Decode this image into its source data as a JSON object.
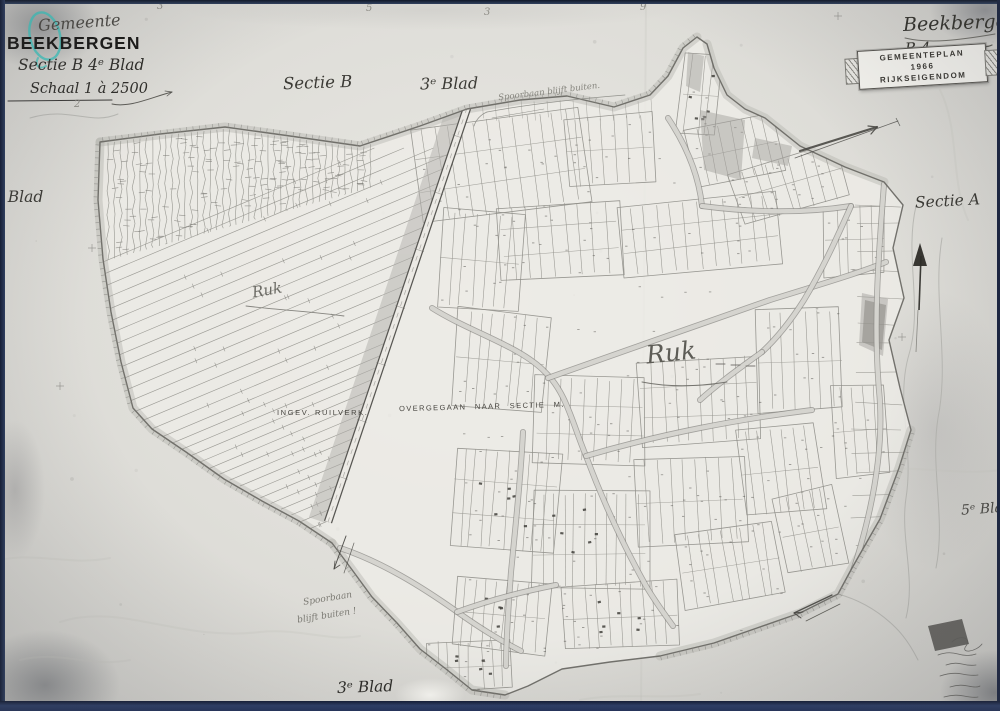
{
  "title_block": {
    "gemeente": "Gemeente",
    "municipality": "BEEKBERGEN",
    "sectie": "Sectie B 4ᵉ Blad",
    "schaal": "Schaal 1 à 2500"
  },
  "top_right": {
    "script_name": "Beekbergen",
    "script_sheet": "B 4.",
    "stamp_line1": "GEMEENTEPLAN 1966",
    "stamp_line2": "RIJKSEIGENDOM"
  },
  "sheet_labels": {
    "sectie_b": "Sectie B",
    "blad_top": "3ᵉ Blad",
    "sectie_a": "Sectie A",
    "blad_left": "5ᵉ Blad",
    "blad_bottom": "3ᵉ Blad",
    "blad_right": "5ᵉ Blad"
  },
  "annotations": {
    "spoorbaan_top": "Spoorbaan blijft buiten.",
    "spoorbaan_bottom_line1": "Spoorbaan",
    "spoorbaan_bottom_line2": "blijft buiten !",
    "ruk_small": "Ruk",
    "ruk_large": "Ruk",
    "ingev_ruilverk": "INGEV. RUILVERK.",
    "overgegaan": "OVERGEGAAN NAAR SECTIE M."
  },
  "edge_numbers": [
    "3",
    "5",
    "3",
    "9",
    "2"
  ],
  "colors": {
    "paper": "#deddd8",
    "paper_light": "#edece7",
    "ink": "#2b2a26",
    "line": "#94938d",
    "boundary": "#6b6a65",
    "band": "#b6b5b0",
    "teal": "#3fc6bf",
    "navy": "#22304f"
  },
  "map_art": {
    "boundary_points": [
      [
        100,
        142
      ],
      [
        160,
        134
      ],
      [
        225,
        127
      ],
      [
        290,
        136
      ],
      [
        360,
        146
      ],
      [
        420,
        126
      ],
      [
        467,
        109
      ],
      [
        520,
        100
      ],
      [
        567,
        96
      ],
      [
        614,
        107
      ],
      [
        650,
        95
      ],
      [
        668,
        76
      ],
      [
        683,
        48
      ],
      [
        697,
        37
      ],
      [
        707,
        44
      ],
      [
        714,
        68
      ],
      [
        727,
        95
      ],
      [
        745,
        109
      ],
      [
        765,
        118
      ],
      [
        800,
        146
      ],
      [
        845,
        167
      ],
      [
        884,
        182
      ],
      [
        903,
        205
      ],
      [
        893,
        248
      ],
      [
        904,
        298
      ],
      [
        889,
        340
      ],
      [
        900,
        388
      ],
      [
        911,
        430
      ],
      [
        899,
        468
      ],
      [
        880,
        519
      ],
      [
        852,
        568
      ],
      [
        838,
        594
      ],
      [
        800,
        613
      ],
      [
        757,
        628
      ],
      [
        714,
        643
      ],
      [
        660,
        656
      ],
      [
        610,
        662
      ],
      [
        562,
        669
      ],
      [
        528,
        686
      ],
      [
        505,
        695
      ],
      [
        472,
        690
      ],
      [
        446,
        669
      ],
      [
        420,
        649
      ],
      [
        397,
        623
      ],
      [
        372,
        597
      ],
      [
        350,
        567
      ],
      [
        332,
        543
      ],
      [
        299,
        521
      ],
      [
        262,
        501
      ],
      [
        224,
        479
      ],
      [
        186,
        452
      ],
      [
        152,
        429
      ],
      [
        133,
        408
      ],
      [
        121,
        362
      ],
      [
        111,
        312
      ],
      [
        103,
        259
      ],
      [
        98,
        200
      ]
    ],
    "railway": {
      "x1": 467,
      "y1": 108,
      "x2": 328,
      "y2": 522
    },
    "roads": [
      "M432,308C470,332 520,346 545,372C566,392 572,422 586,456C601,496 621,541 646,586C656,603 666,616 673,626",
      "M548,378C620,352 700,325 770,300C822,284 862,272 886,262",
      "M668,118C688,148 699,178 702,206",
      "M702,206C748,212 800,214 851,206",
      "M851,206C836,240 822,270 804,300C790,322 775,340 762,352",
      "M884,184C879,250 873,320 879,390C885,450 871,520 847,589",
      "M340,548C382,562 422,587 456,611C481,629 501,641 521,651",
      "M523,432C521,472 516,522 511,572C508,612 506,642 506,666",
      "M586,456C620,446 660,436 700,428C740,420 780,414 812,410",
      "M457,612C490,600 520,592 556,585",
      "M762,352C740,368 720,382 700,400"
    ],
    "band_runs": [
      {
        "pts": [
          [
            100,
            142
          ],
          [
            225,
            127
          ],
          [
            290,
            136
          ],
          [
            360,
            146
          ],
          [
            420,
            126
          ],
          [
            467,
            109
          ],
          [
            520,
            100
          ],
          [
            567,
            96
          ],
          [
            614,
            107
          ],
          [
            650,
            95
          ],
          [
            668,
            76
          ],
          [
            683,
            48
          ],
          [
            697,
            37
          ]
        ],
        "sgn": 1,
        "tick": 1
      },
      {
        "pts": [
          [
            707,
            44
          ],
          [
            714,
            68
          ],
          [
            727,
            95
          ],
          [
            745,
            109
          ],
          [
            765,
            118
          ],
          [
            800,
            146
          ],
          [
            845,
            167
          ],
          [
            884,
            182
          ]
        ],
        "sgn": 1,
        "tick": 0
      },
      {
        "pts": [
          [
            100,
            142
          ],
          [
            98,
            200
          ],
          [
            103,
            259
          ],
          [
            111,
            312
          ],
          [
            121,
            362
          ],
          [
            133,
            408
          ],
          [
            152,
            429
          ],
          [
            186,
            452
          ],
          [
            224,
            479
          ],
          [
            262,
            501
          ],
          [
            299,
            521
          ],
          [
            332,
            543
          ]
        ],
        "sgn": -1,
        "tick": 1
      },
      {
        "pts": [
          [
            911,
            430
          ],
          [
            899,
            468
          ],
          [
            880,
            519
          ],
          [
            852,
            568
          ],
          [
            838,
            594
          ],
          [
            800,
            613
          ],
          [
            757,
            628
          ],
          [
            714,
            643
          ],
          [
            660,
            656
          ]
        ],
        "sgn": 1,
        "tick": 1
      },
      {
        "pts": [
          [
            332,
            543
          ],
          [
            350,
            567
          ],
          [
            372,
            597
          ],
          [
            397,
            623
          ],
          [
            420,
            649
          ],
          [
            446,
            669
          ],
          [
            472,
            690
          ],
          [
            505,
            695
          ]
        ],
        "sgn": -1,
        "tick": 1
      }
    ]
  }
}
